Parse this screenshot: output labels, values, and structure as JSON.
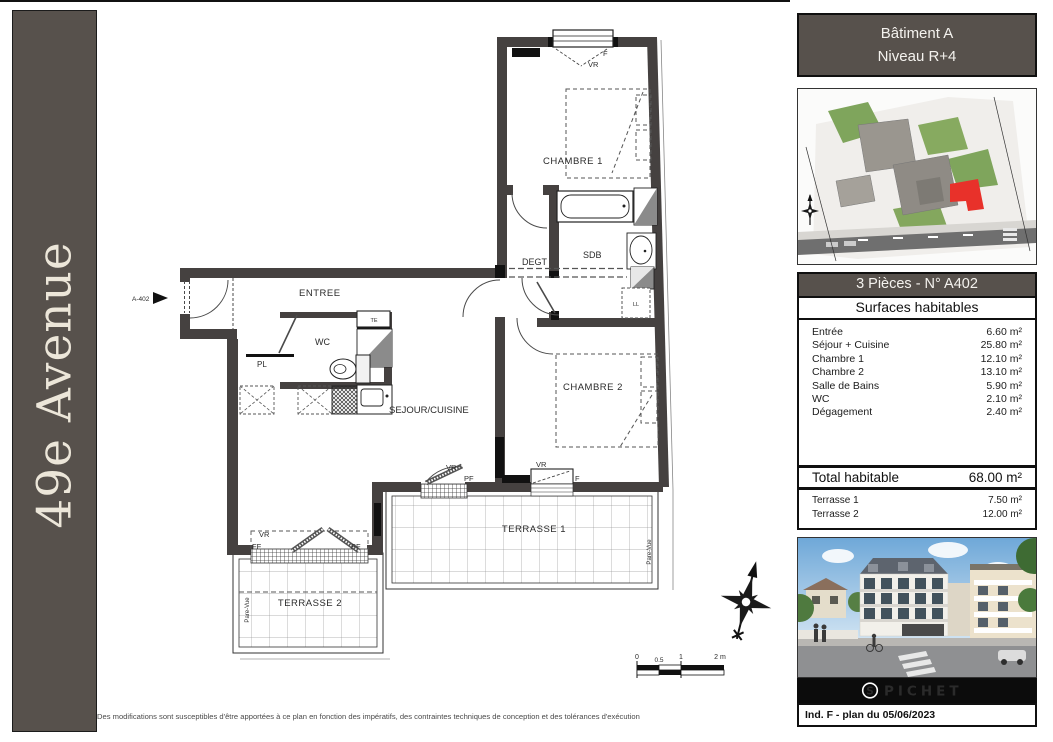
{
  "banner": {
    "title": "49e Avenue"
  },
  "info_header": {
    "line1": "Bâtiment A",
    "line2": "Niveau R+4"
  },
  "unit_panel": {
    "title": "3 Pièces - N° A402",
    "subtitle": "Surfaces habitables",
    "rows": [
      {
        "label": "Entrée",
        "value": "6.60 m²"
      },
      {
        "label": "Séjour + Cuisine",
        "value": "25.80 m²"
      },
      {
        "label": "Chambre 1",
        "value": "12.10 m²"
      },
      {
        "label": "Chambre 2",
        "value": "13.10 m²"
      },
      {
        "label": "Salle de Bains",
        "value": "5.90 m²"
      },
      {
        "label": "WC",
        "value": "2.10 m²"
      },
      {
        "label": "Dégagement",
        "value": "2.40 m²"
      }
    ],
    "total": {
      "label": "Total habitable",
      "value": "68.00 m²"
    },
    "terraces": [
      {
        "label": "Terrasse 1",
        "value": "7.50 m²"
      },
      {
        "label": "Terrasse 2",
        "value": "12.00 m²"
      }
    ]
  },
  "plan": {
    "unit_ref": "A-402",
    "rooms": {
      "chambre1": "CHAMBRE 1",
      "chambre2": "CHAMBRE 2",
      "sdb": "SDB",
      "degt": "DEGT",
      "entree": "ENTREE",
      "wc": "WC",
      "sejour": "SEJOUR/CUISINE",
      "terrasse1": "TERRASSE 1",
      "terrasse2": "TERRASSE 2"
    },
    "annotations": {
      "vr": "VR",
      "f": "F",
      "pf": "PF",
      "ff": "FF",
      "te": "TE",
      "pl": "PL",
      "ll": "LL",
      "pare_vue": "Pare-Vue"
    },
    "scale": {
      "t0": "0",
      "t05": "0.5",
      "t1": "1",
      "t2": "2 m"
    }
  },
  "footer": {
    "disclaimer": "Des modifications sont susceptibles d'être apportées à ce plan en fonction des impératifs, des contraintes techniques de conception et des tolérances d'exécution",
    "brand": "PICHET",
    "brand_initial": "S",
    "revision": "Ind. F - plan du 05/06/2023"
  },
  "colors": {
    "accent": "#57514C",
    "wall": "#454140",
    "unit_red": "#E8312A"
  }
}
